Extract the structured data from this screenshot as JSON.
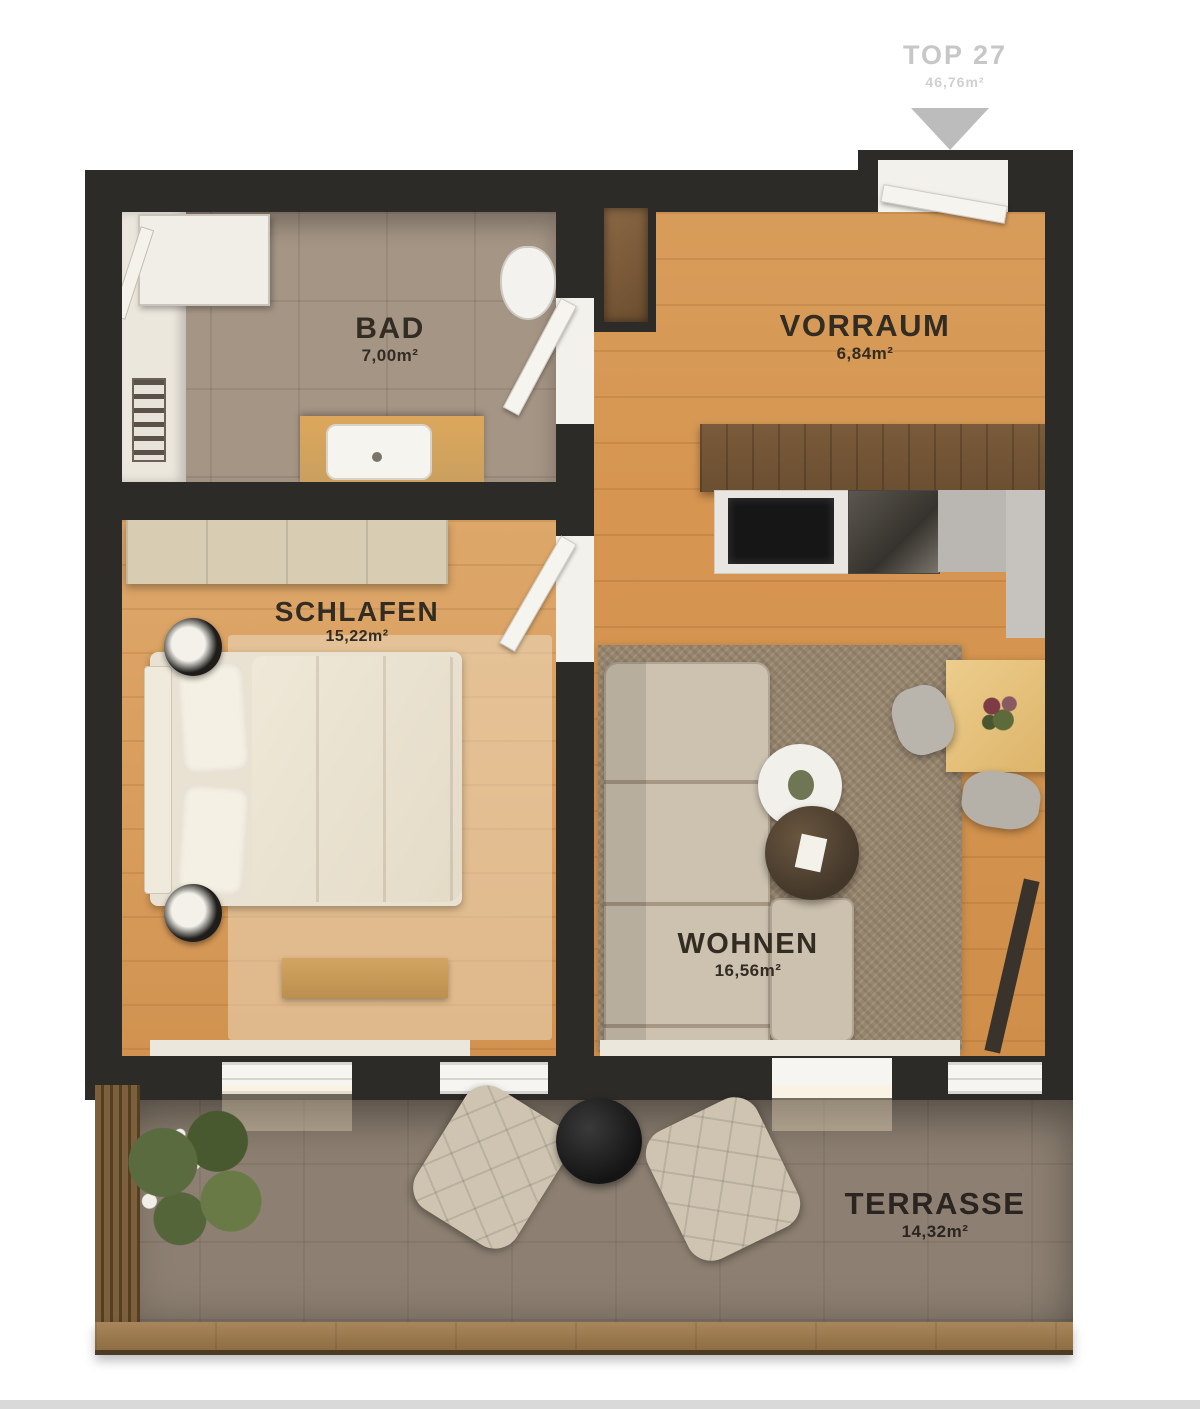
{
  "header": {
    "unit": "TOP 27",
    "total_area": "46,76m²"
  },
  "rooms": [
    {
      "id": "bad",
      "name": "BAD",
      "area": "7,00m²"
    },
    {
      "id": "vorraum",
      "name": "VORRAUM",
      "area": "6,84m²"
    },
    {
      "id": "schlafen",
      "name": "SCHLAFEN",
      "area": "15,22m²"
    },
    {
      "id": "wohnen",
      "name": "WOHNEN",
      "area": "16,56m²"
    },
    {
      "id": "terrasse",
      "name": "TERRASSE",
      "area": "14,32m²"
    }
  ],
  "colors": {
    "wall": "#2c2b28",
    "wood_floor": "#d69550",
    "bath_tile": "#a59585",
    "terrace_tile": "#8d8072",
    "label_text": "#332c23",
    "header_text": "#c7c7c7"
  }
}
